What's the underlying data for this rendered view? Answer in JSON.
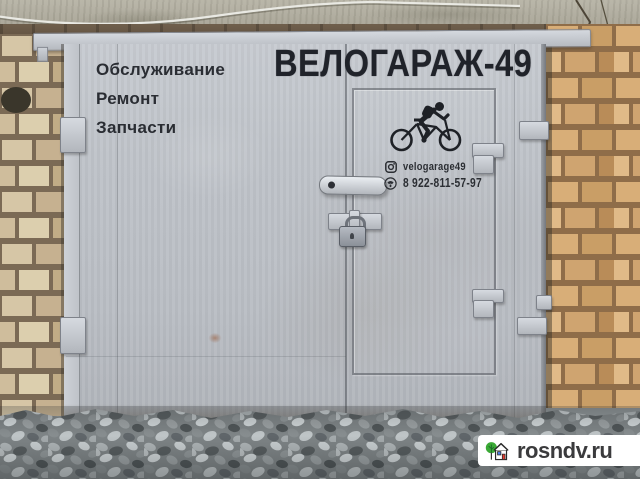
{
  "signage": {
    "title": "ВЕЛОГАРАЖ-49",
    "services": [
      "Обслуживание",
      "Ремонт",
      "Запчасти"
    ],
    "instagram_handle": "velogarage49",
    "phone": "8 922-811-57-97"
  },
  "watermark": {
    "site": "rosndv.ru"
  },
  "icons": {
    "cyclist": "cyclist-icon",
    "instagram": "instagram-icon",
    "phone": "phone-icon",
    "logo_tree": "tree-icon",
    "logo_house": "house-icon"
  },
  "colors": {
    "door_metal": "#bfc3c9",
    "sign_text": "#26292e",
    "brick_left": "#cdb795",
    "brick_right": "#d2a873",
    "gravel": "#7e8486",
    "watermark_bg": "#ffffff",
    "watermark_text": "#3b3b3d",
    "logo_green": "#3aa935",
    "logo_red": "#e8392e",
    "logo_blue": "#4a7ce0"
  }
}
